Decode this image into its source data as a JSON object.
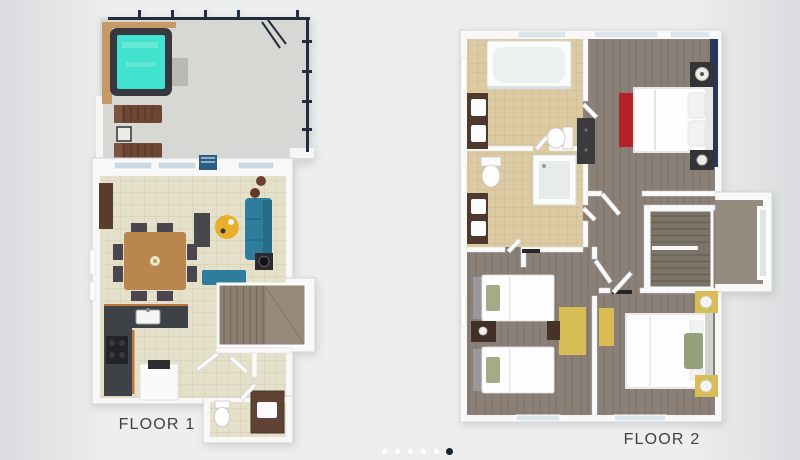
{
  "carousel": {
    "dots_total": 6,
    "active_index": 5
  },
  "slides": [
    {
      "id": "floor-1",
      "label": "FLOOR 1"
    },
    {
      "id": "floor-2",
      "label": "FLOOR 2"
    }
  ],
  "palette": {
    "background_edge": "#d9dcde",
    "background_center": "#edeeee",
    "label_text": "#3b4148",
    "dot_active": "#1a2330",
    "dot_inactive": "#fafbfb",
    "hot_tub_water": "#41e3cf",
    "sofa_teal": "#2f7d9d",
    "accent_wall_navy": "#26395b",
    "bench_red": "#b6212b",
    "desk_yellow": "#d8bc55",
    "living_tile": "#e5e0c9",
    "bath_tile": "#dccaa2",
    "wood_floor": "#8b8078",
    "deck_concrete": "#d7d8d4",
    "railing_navy": "#232d3c"
  }
}
